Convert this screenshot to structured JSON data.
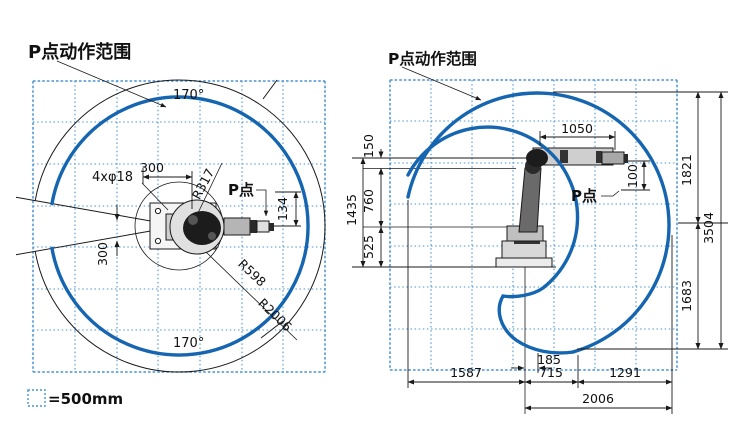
{
  "left_view": {
    "title": "P点动作范围",
    "angle_top": "170°",
    "angle_bottom": "170°",
    "dim_width": "300",
    "dim_slot": "300",
    "bolt_holes": "4xφ18",
    "radius_inner": "R317",
    "radius_mid": "R598",
    "radius_outer": "R2006",
    "p_point": "P点",
    "dim_offset": "134"
  },
  "right_view": {
    "title": "P点动作范围",
    "p_point": "P点",
    "dim_arm": "1050",
    "dim_wrist": "100",
    "dim_150": "150",
    "dim_760": "760",
    "dim_525": "525",
    "dim_1435": "1435",
    "dim_1821": "1821",
    "dim_3504": "3504",
    "dim_1683": "1683",
    "dim_185": "185",
    "dim_1587": "1587",
    "dim_715": "715",
    "dim_1291": "1291",
    "dim_2006": "2006"
  },
  "legend": {
    "label": "=500mm"
  },
  "colors": {
    "envelope": "#1565b0",
    "grid": "#4a94d4"
  }
}
